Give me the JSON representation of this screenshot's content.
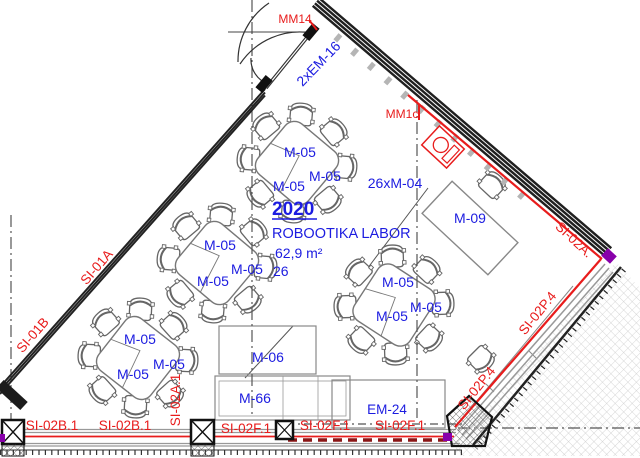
{
  "room": {
    "number": "2020",
    "name": "ROBOOTIKA LABOR",
    "area": "62,9 m²",
    "capacity": "26"
  },
  "furniture": {
    "table_label": "M-05",
    "chairs_total_label": "26xM-04",
    "teacher_desk_label": "M-09",
    "board_label": "M-06",
    "cabinet_label": "M-66",
    "equipment_label": "EM-24",
    "door_label": "2xEM-16"
  },
  "markers": {
    "mm14": "MM14",
    "mm1c": "MM1c"
  },
  "wall_tags": {
    "left_upper": "SI-01A",
    "left_lower": "SI-01B",
    "bottom_b1": "SI-02B.1",
    "bottom_b2": "SI-02B.1",
    "bottom_vertical": "SI-02A.1",
    "bottom_f1": "SI-02F.1",
    "bottom_f2": "SI-02F.1",
    "bottom_f3": "SI-02F.1",
    "right_corner": "SI-02A.",
    "right_diag_1": "SI-02P.4",
    "right_diag_2": "SI-02P.4"
  },
  "colors": {
    "label_blue": "#1c1ce0",
    "tag_red": "#e81c1c",
    "barrier_dark_red": "#8a1616",
    "accent_purple": "#8800aa",
    "wall_dark": "#1f1f1f",
    "hatch_gray": "#c8c8c8"
  }
}
